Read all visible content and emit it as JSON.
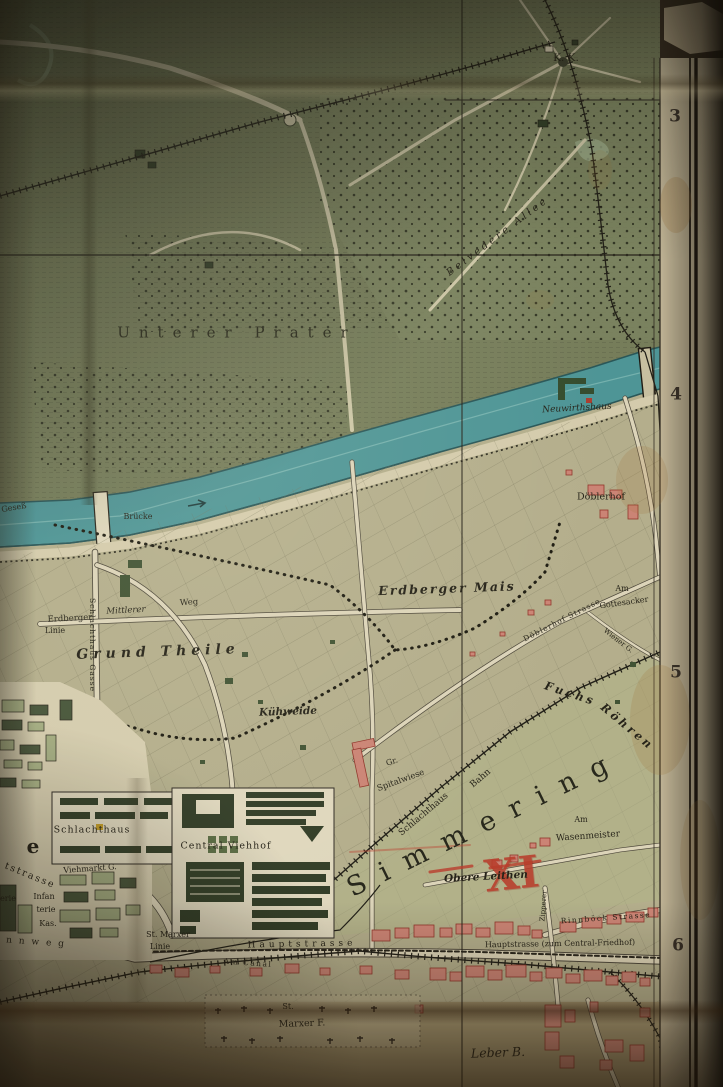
{
  "map": {
    "labels": {
      "unterer_prater": "Unterer Prater",
      "belvedere_allee": "Belvedere Allee",
      "kk": "K. K.",
      "neuwirthshaus": "Neuwirthshaus",
      "bruecke": "Brücke",
      "gesess": "Geseß",
      "doeblerhof": "Döblerhof",
      "erdberger": "Erdberger",
      "mittlerer": "Mittlerer",
      "weg": "Weg",
      "linie_erdberger": "Linie",
      "grund_theile": "Grund Theile",
      "kuehweide": "Kühweide",
      "erdberger_mais": "Erdberger Mais",
      "doeblerhof_strasse": "Döblerhof Strasse",
      "am_gottesacker_1": "Am",
      "am_gottesacker_2": "Gottesacker",
      "wiener_g": "Wiener G.",
      "fuchs": "Fuchs",
      "roehren": "Röhren",
      "gr": "Gr.",
      "spitalwiese": "Spitalwiese",
      "schlachthaus_bahn_1": "Schlachthaus",
      "schlachthaus_bahn_2": "Bahn",
      "simmering": "Simmering",
      "district_number": "XI",
      "am_wasenmeister_1": "Am",
      "am_wasenmeister_2": "Wasenmeister",
      "obere_leithen": "Obere Leithen",
      "schlachthaus": "Schlachthaus",
      "central_viehhof": "Central Viehhof",
      "viehmarkt_g": "Viehmarkt G.",
      "schlachthaus_gasse": "Schlachthaus Gasse",
      "letter_e": "e",
      "tstrasse": "tstrasse",
      "inf_1": "erie",
      "inf_2": "Infan",
      "inf_3": "terie",
      "inf_4": "Kas.",
      "rennweg": "n n w e g",
      "st_marxer": "St. Marxer",
      "linie_st_marxer": "Linie",
      "hauptstrasse": "Hauptstrasse",
      "am_canal": "Am Canal",
      "hauptstrasse_friedhof": "Hauptstrasse (zum Central-Friedhof)",
      "rinnboeck_strasse": "Rinnböck Strasse",
      "zipperer": "Zipperer",
      "st_marxer_f_1": "St.",
      "st_marxer_f_2": "Marxer F.",
      "leber_b": "Leber B."
    },
    "grid": {
      "numbers": [
        "3",
        "4",
        "5",
        "6"
      ]
    },
    "colors": {
      "river_teal": "#4a9aa0",
      "parkland_green": "#76805e",
      "fields_khaki": "#bab695",
      "building_pink": "#d4887c",
      "building_dark_green": "#2c3b27",
      "annotation_red": "#c13a2c",
      "paper_margin_cream": "#cbc0a2"
    }
  }
}
